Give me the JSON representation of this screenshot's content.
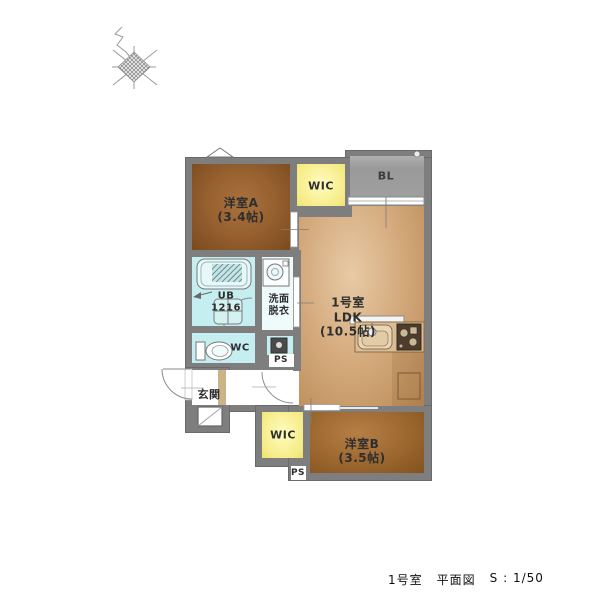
{
  "title": {
    "room": "1号室",
    "drawing": "平面図",
    "scale": "S : 1/50"
  },
  "rooms": {
    "yoshitsu_a": {
      "name": "洋室A",
      "size": "(3.4帖)"
    },
    "wic_top": {
      "label": "WIC"
    },
    "balcony": {
      "label": "BL"
    },
    "ldk": {
      "unit": "1号室",
      "name": "LDK",
      "size": "(10.5帖)"
    },
    "ub": {
      "name": "UB",
      "size": "1216"
    },
    "senmen": {
      "line1": "洗面",
      "line2": "脱衣"
    },
    "wc": {
      "label": "WC"
    },
    "ps_mid": {
      "label": "PS"
    },
    "genkan": {
      "label": "玄関"
    },
    "wic_bottom": {
      "label": "WIC"
    },
    "yoshitsu_b": {
      "name": "洋室B",
      "size": "(3.5帖)"
    },
    "ps_bottom": {
      "label": "PS"
    }
  },
  "fixtures": [
    "north-compass",
    "vent-triangle",
    "drain-cap",
    "balcony-window",
    "bathtub",
    "shower-faucet",
    "washing-area",
    "toilet",
    "washing-machine-pan",
    "water-heater",
    "kitchen-sink",
    "gas-stove",
    "range-hood",
    "refrigerator-space",
    "shoe-cabinet",
    "entrance-door",
    "hall-door",
    "bath-door",
    "sliding-door"
  ],
  "colors": {
    "wall": "#7e7e7e",
    "room_brown": "#96602f",
    "ldk_floor": "#d4aa7d",
    "wic_yellow": "#f6eb85",
    "balcony_gray": "#a2a2a2",
    "wet_cyan": "#c4eef0",
    "text": "#2e2e2e"
  }
}
